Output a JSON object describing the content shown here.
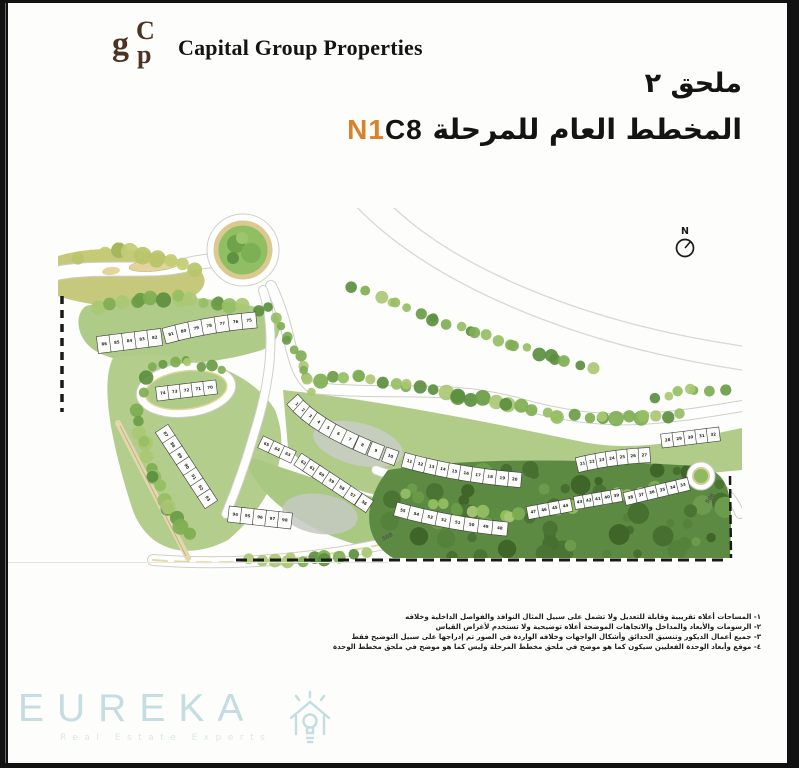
{
  "header": {
    "monogram": {
      "g": "g",
      "c": "C",
      "p": "p"
    },
    "logo_text": "Capital Group Properties"
  },
  "title": {
    "line1": "ملحق ٢",
    "line2_arabic": "المخطط العام للمرحلة",
    "phase_orange": "N1",
    "phase_black": "C8"
  },
  "plan": {
    "compass_label": "N",
    "road_labels": [
      "508",
      "506"
    ],
    "unit_rows": [
      {
        "name": "row-86-82",
        "numbers": [
          "86",
          "85",
          "84",
          "83",
          "82"
        ]
      },
      {
        "name": "row-81-75",
        "numbers": [
          "81",
          "80",
          "79",
          "78",
          "77",
          "76",
          "75"
        ]
      },
      {
        "name": "row-74-70",
        "numbers": [
          "74",
          "73",
          "72",
          "71",
          "70"
        ]
      },
      {
        "name": "row-87-93",
        "numbers": [
          "87",
          "88",
          "89",
          "90",
          "91",
          "92",
          "93"
        ]
      },
      {
        "name": "row-94-98",
        "numbers": [
          "94",
          "95",
          "96",
          "97",
          "98"
        ]
      },
      {
        "name": "row-1-10",
        "numbers": [
          "1",
          "2",
          "3",
          "4",
          "5",
          "6",
          "7",
          "8",
          "9",
          "10"
        ]
      },
      {
        "name": "row-11-20",
        "numbers": [
          "11",
          "12",
          "13",
          "14",
          "15",
          "16",
          "17",
          "18",
          "19",
          "20"
        ]
      },
      {
        "name": "row-21-27",
        "numbers": [
          "21",
          "22",
          "23",
          "24",
          "25",
          "26",
          "27"
        ]
      },
      {
        "name": "row-28-32",
        "numbers": [
          "28",
          "29",
          "30",
          "31",
          "32"
        ]
      },
      {
        "name": "row-65-63",
        "numbers": [
          "65",
          "64",
          "63"
        ]
      },
      {
        "name": "row-62-56",
        "numbers": [
          "62",
          "61",
          "60",
          "59",
          "58",
          "57",
          "56"
        ]
      },
      {
        "name": "row-55-48",
        "numbers": [
          "55",
          "54",
          "53",
          "52",
          "51",
          "50",
          "49",
          "48"
        ]
      },
      {
        "name": "row-47-44",
        "numbers": [
          "47",
          "46",
          "45",
          "44"
        ]
      },
      {
        "name": "row-43-39",
        "numbers": [
          "43",
          "42",
          "41",
          "40",
          "39"
        ]
      },
      {
        "name": "row-38-33",
        "numbers": [
          "38",
          "37",
          "36",
          "35",
          "34",
          "33"
        ]
      }
    ]
  },
  "footnotes": {
    "lines": [
      "١- المساحات أعلاه تقريبية وقابلة للتعديل ولا تشمل على سبيل المثال النوافذ والفواصل الداخلية وخلافه",
      "٢- الرسومات والأبعاد والمداخل والاتجاهات الموضحة أعلاه توضيحية ولا تستخدم لأغراض القياس",
      "٣- جميع أعمال الديكور وتنسيق الحدائق وأشكال الواجهات وخلافه الواردة في الصور تم إدراجها على سبيل التوضيح فقط",
      "٤- موقع وأبعاد الوحدة الفعليين سيكون كما هو موضح في ملحق مخطط المرحلة وليس كما هو موضح في ملحق مخطط الوحدة"
    ]
  },
  "watermark": {
    "name": "EUREKA",
    "tagline": "Real Estate Experts"
  },
  "colors": {
    "accent_orange": "#d9822b",
    "grass": "#aecb87",
    "olive": "#c6c97c",
    "forest": "#5d8a42",
    "path_beige": "#e3d49b",
    "watermark_teal": "#c3dde0"
  }
}
